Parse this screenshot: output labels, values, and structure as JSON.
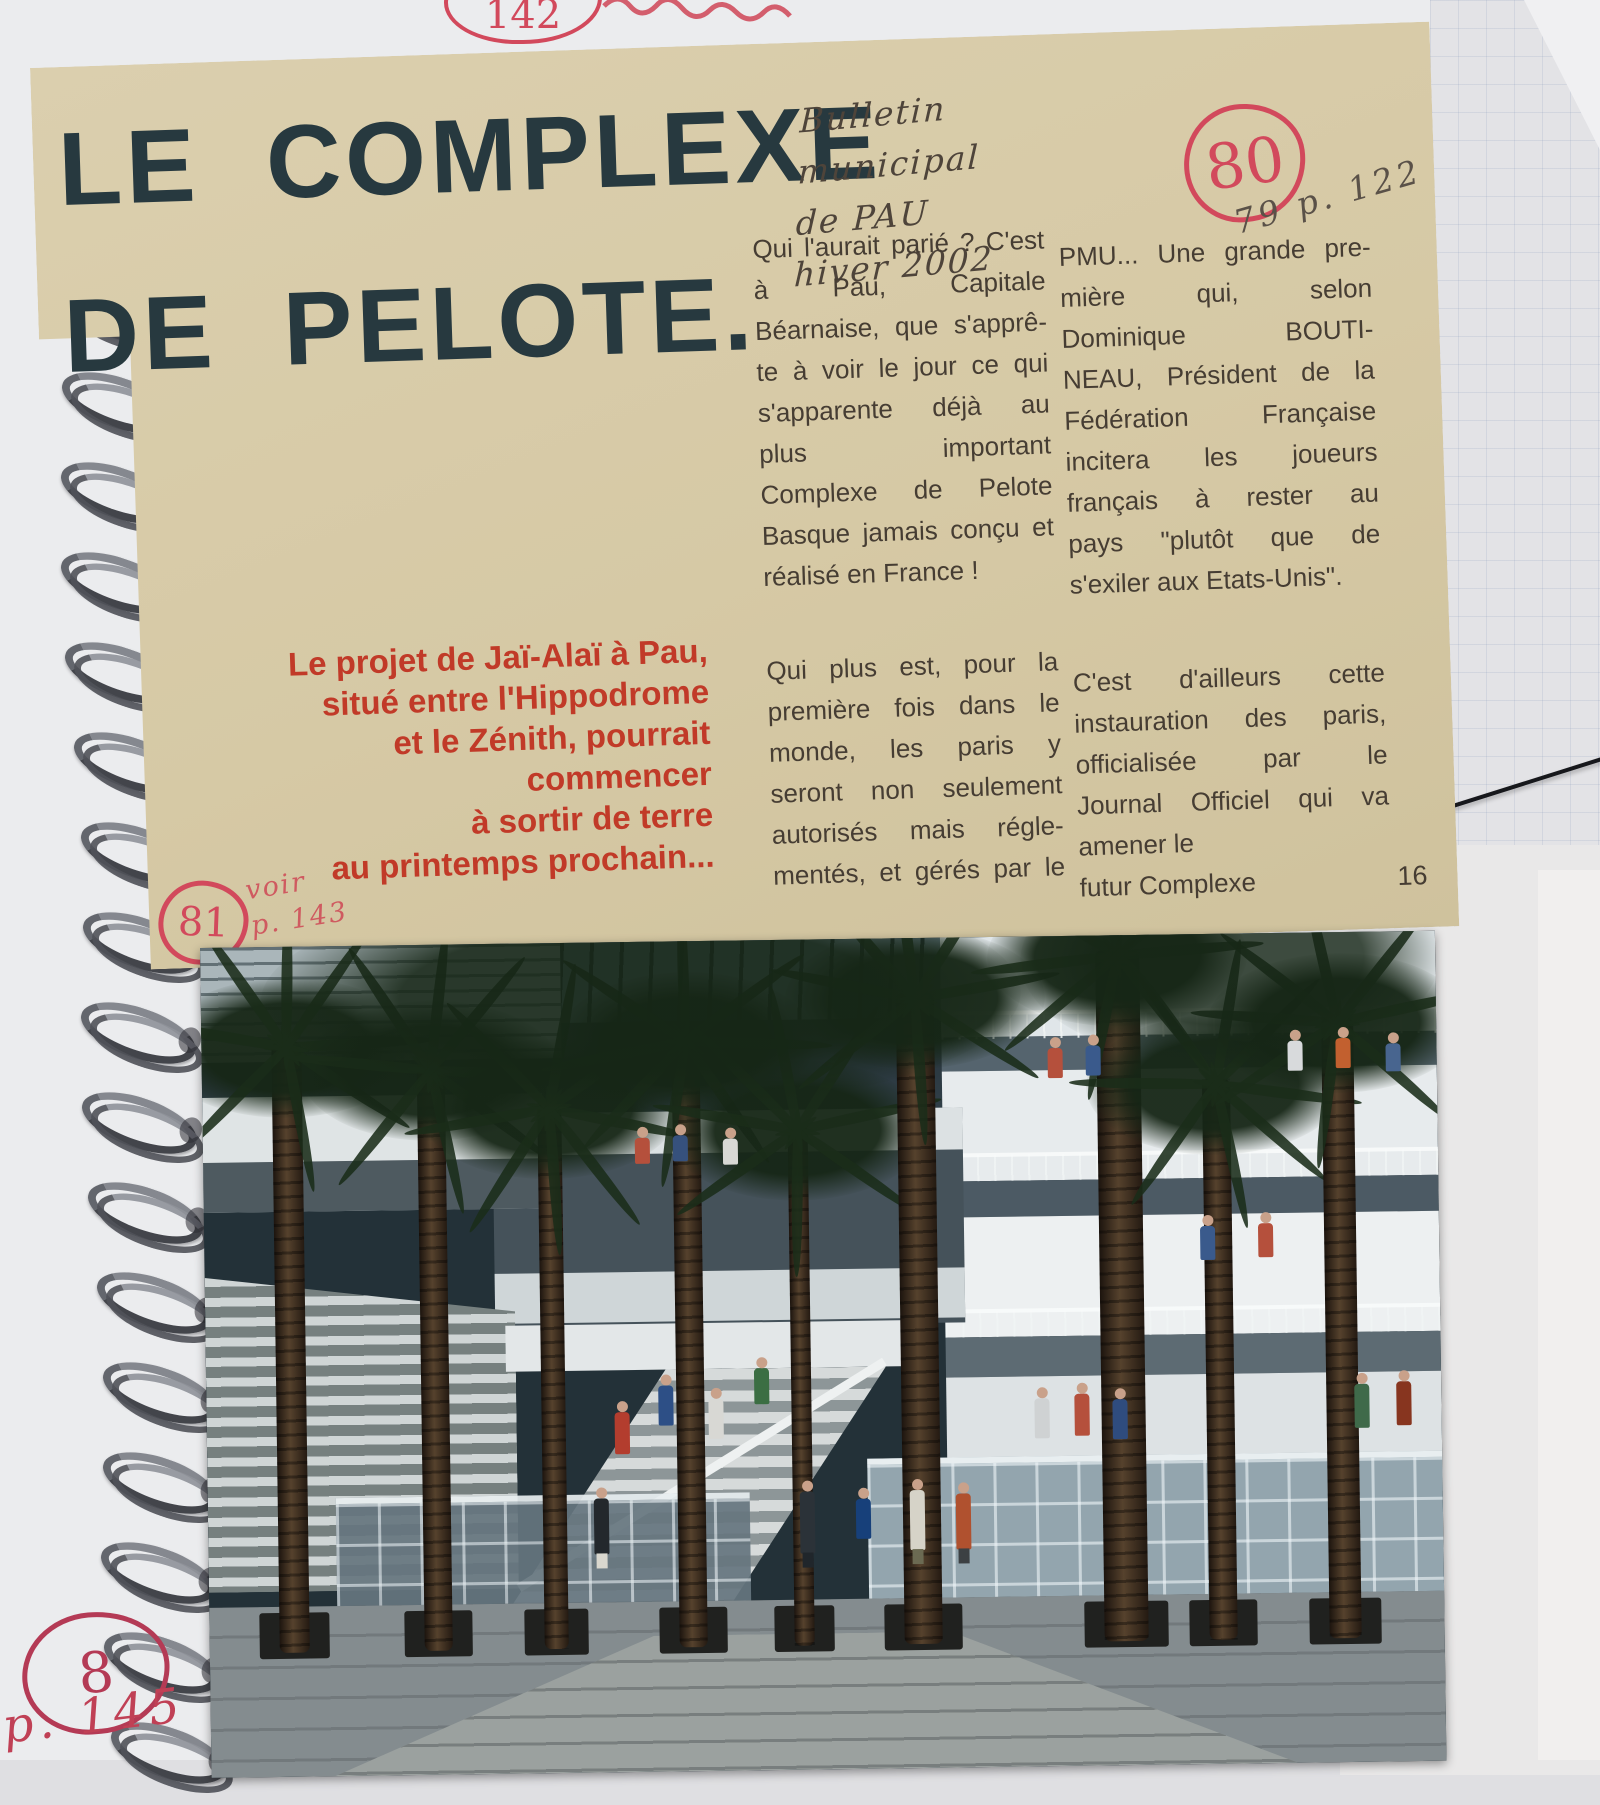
{
  "notebook": {
    "top_circled_number": "142",
    "bottom_circled_number": "8",
    "bottom_page_ref": "p. 145"
  },
  "clipping": {
    "title": {
      "line1": "LE COMPLEXE",
      "line2": "DE PELOTE."
    },
    "handwritten_source": {
      "lines": [
        "Bulletin",
        "municipal",
        "de PAU",
        "hiver 2002"
      ]
    },
    "red_circled_number": "80",
    "pencil_ref": "79 p. 122",
    "margin_mark": {
      "circled_number": "81",
      "see_lines": [
        "voir",
        "p. 143"
      ]
    },
    "deck_lines": [
      "Le projet de Jaï-Alaï à Pau,",
      "situé entre l'Hippodrome",
      "et le Zénith, pourrait commencer",
      "à sortir de terre",
      "au printemps prochain..."
    ],
    "article": {
      "col1_lines": [
        "Qui l'aurait parié ? C'est",
        "à Pau, Capitale",
        "Béarnaise, que s'apprê-",
        "te à voir le jour ce qui",
        "s'apparente déjà au",
        "plus important",
        "Complexe de Pelote",
        "Basque jamais conçu et",
        "réalisé en France !"
      ],
      "col2_lines": [
        "PMU... Une grande pre-",
        "mière qui, selon",
        "Dominique BOUTI-",
        "NEAU, Président de la",
        "Fédération Française",
        "incitera les joueurs",
        "français à rester au",
        "pays \"plutôt que de",
        "s'exiler aux Etats-Unis\"."
      ],
      "col3_lines": [
        "Qui plus est, pour la",
        "première fois dans le",
        "monde, les paris y",
        "seront non seulement",
        "autorisés mais régle-",
        "mentés, et gérés par le"
      ],
      "col4_lines": [
        "C'est d'ailleurs cette",
        "instauration des paris,",
        "officialisée par le",
        "Journal Officiel qui va",
        "amener le",
        "futur Complexe"
      ],
      "page_number": "16"
    },
    "photo_alt": "Architectural rendering of the planned pelota complex atrium in Pau: tall palm trees, white multi-level balconies, central staircase, glass-block walls and people walking on a stone floor"
  }
}
